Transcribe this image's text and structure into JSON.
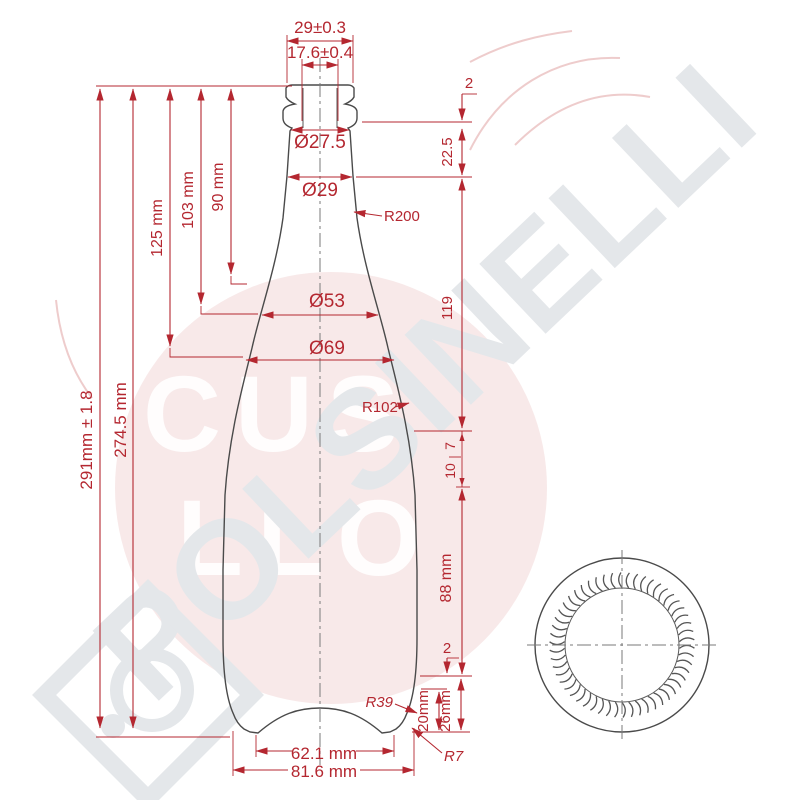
{
  "dims": {
    "w29": "29±0.3",
    "w176": "17.6±0.4",
    "d275": "Ø27.5",
    "d29": "Ø29",
    "r200": "R200",
    "d53": "Ø53",
    "d69": "Ø69",
    "r102": "R102",
    "h90": "90 mm",
    "h103": "103 mm",
    "h125": "125 mm",
    "h2745": "274.5 mm",
    "h291": "291mm ± 1.8",
    "s2top": "2",
    "s225": "22.5",
    "s119": "119",
    "s10": "10",
    "s7": "7",
    "s88": "88 mm",
    "s2bot": "2",
    "s20": "20mm",
    "s26": "26mm",
    "r39": "R39",
    "r7": "R7",
    "b621": "62.1 mm",
    "b816": "81.6 mm"
  },
  "watermark": {
    "brand": "POLSINELLI",
    "circle_row1": "CUS",
    "circle_row2": "LLO"
  },
  "colors": {
    "dimension_red": "#b42730",
    "outline_dark": "#4a4a4a",
    "watermark_gray": "#e4e7ea",
    "stamp_pink": "#eec9c9"
  }
}
